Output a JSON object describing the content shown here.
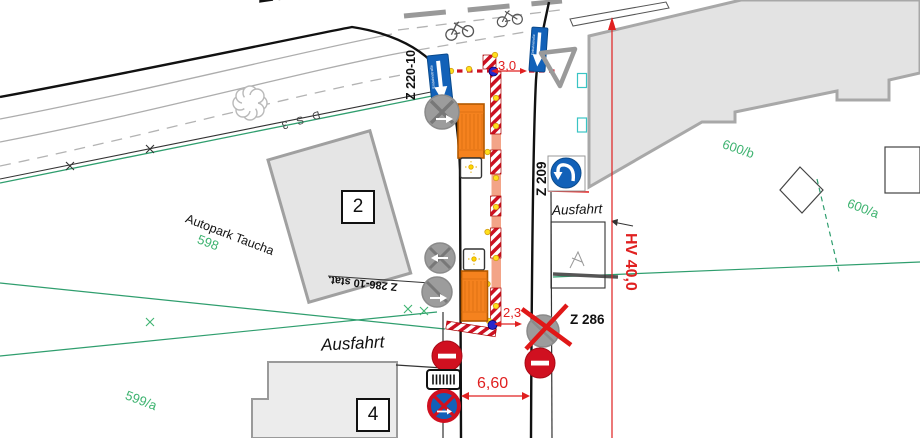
{
  "canvas": {
    "width": 920,
    "height": 438,
    "type": "traffic-sign-site-plan"
  },
  "texts": {
    "street_name_partial": "Eu.",
    "sign_label_z220": "Z 220-10",
    "sign_label_z209": "Z 209",
    "sign_label_z286": "Z  286",
    "sign_label_z286_stat": "Z 286-10 stat.",
    "drawing_label_ds3": "D S 3",
    "site_label_autopark": "Autopark Taucha",
    "exit_label_bottom": "Ausfahrt",
    "exit_label_right": "Ausfahrt",
    "parcel_598": "598",
    "parcel_599a": "599/a",
    "parcel_600b": "600/b",
    "parcel_600a": "600/a",
    "building_2": "2",
    "building_4": "4",
    "dim_width_top": "3,0",
    "dim_width_bottom": "2,3",
    "dim_road_width": "6,60",
    "dim_haltverbot": "HV 40,0",
    "einbahnstrasse": "Einbahnstraße"
  },
  "icons": {
    "one_way_sign": "blue rectangle with white down arrow (Einbahnstraße)",
    "no_entry_sign": "red circle with white bar",
    "no_stopping_sign": "blue circle, red ring and red X with white arrow",
    "turn_left_sign": "blue circle with white curved left arrow",
    "yield_triangle": "gray outlined triangle",
    "crossed_out_sign": "gray circle with X (sign to be removed/covered)",
    "barrier_plate": "white plate with vertical bars",
    "warning_lamp": "yellow lamp dot",
    "safety_vehicle": "orange truck with white cab",
    "bicycle": "bicycle outline symbol",
    "tree": "cloud shaped tree outline"
  },
  "colors": {
    "dimension_red": "#e02020",
    "barrier_red": "#cc1122",
    "work_zone_salmon": "#f3a488",
    "truck_orange": "#f5821e",
    "sign_blue": "#1261b8",
    "parcel_green": "#3eb370",
    "boundary_teal": "#2f9e6e",
    "building_gray": "#e5e5e5",
    "disabled_sign_gray": "#9c9c9c",
    "lamp_yellow": "#ffdf1b",
    "marker_blue_dot": "#2727cc"
  }
}
